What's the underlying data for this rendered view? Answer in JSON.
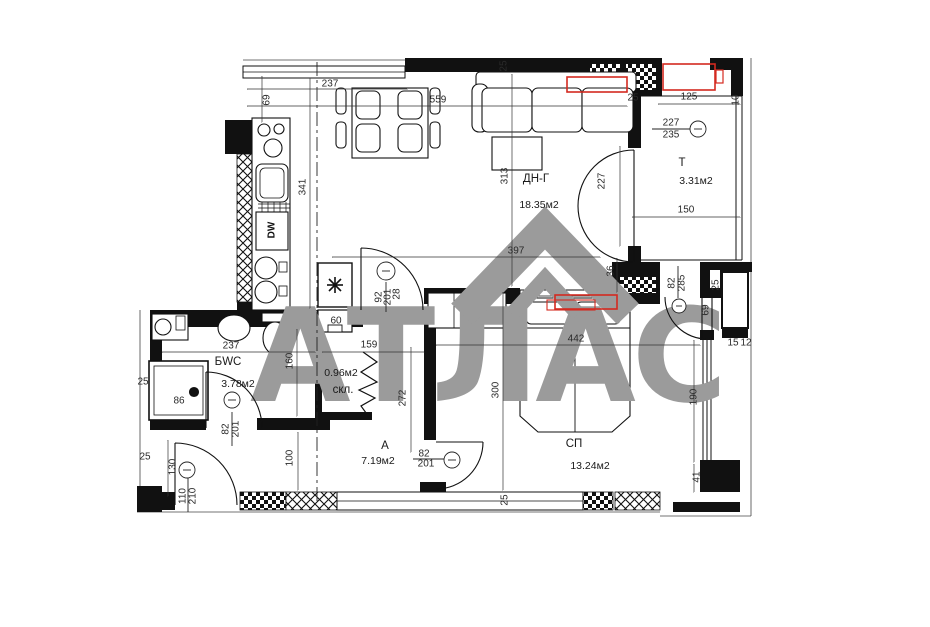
{
  "watermark": {
    "text": "АТЛАС"
  },
  "colors": {
    "ink": "#0f0f0f",
    "red": "#d42a20",
    "watermark_gray": "#9b9b9b"
  },
  "rooms": [
    {
      "name": "ДН-Г",
      "area": "18.35м2",
      "nx": 536,
      "ny": 179,
      "ax": 539,
      "ay": 205
    },
    {
      "name": "Т",
      "area": "3.31м2",
      "nx": 682,
      "ny": 163,
      "ax": 696,
      "ay": 181
    },
    {
      "name": "БWC",
      "area": "3.78м2",
      "nx": 228,
      "ny": 362,
      "ax": 238,
      "ay": 384
    },
    {
      "name": "скл.",
      "area": "0.96м2",
      "nx": 343,
      "ny": 390,
      "ax": 341,
      "ay": 373
    },
    {
      "name": "А",
      "area": "7.19м2",
      "nx": 385,
      "ny": 446,
      "ax": 378,
      "ay": 461
    },
    {
      "name": "СП",
      "area": "13.24м2",
      "nx": 574,
      "ny": 444,
      "ax": 590,
      "ay": 466
    }
  ],
  "labels": [
    {
      "t": "237",
      "x": 330,
      "y": 84
    },
    {
      "t": "69",
      "x": 267,
      "y": 100,
      "r": -90
    },
    {
      "t": "559",
      "x": 438,
      "y": 100
    },
    {
      "t": "25",
      "x": 504,
      "y": 66,
      "r": -90
    },
    {
      "t": "25",
      "x": 633,
      "y": 98
    },
    {
      "t": "125",
      "x": 689,
      "y": 97
    },
    {
      "t": "10",
      "x": 736,
      "y": 100,
      "r": -90
    },
    {
      "t": "227",
      "x": 671,
      "y": 123
    },
    {
      "t": "235",
      "x": 671,
      "y": 135
    },
    {
      "t": "150",
      "x": 686,
      "y": 210
    },
    {
      "t": "227",
      "x": 602,
      "y": 181,
      "r": -90
    },
    {
      "t": "313",
      "x": 505,
      "y": 176,
      "r": -90
    },
    {
      "t": "341",
      "x": 303,
      "y": 187,
      "r": -90
    },
    {
      "t": "397",
      "x": 516,
      "y": 251
    },
    {
      "t": "36",
      "x": 611,
      "y": 271,
      "r": -90
    },
    {
      "t": "92",
      "x": 379,
      "y": 297,
      "r": -90
    },
    {
      "t": "201",
      "x": 388,
      "y": 297,
      "r": -90
    },
    {
      "t": "28",
      "x": 397,
      "y": 294,
      "r": -90
    },
    {
      "t": "82",
      "x": 672,
      "y": 283,
      "r": -90
    },
    {
      "t": "285",
      "x": 682,
      "y": 283,
      "r": -90
    },
    {
      "t": "25",
      "x": 716,
      "y": 285,
      "r": -90
    },
    {
      "t": "69",
      "x": 706,
      "y": 310,
      "r": -90
    },
    {
      "t": "60",
      "x": 336,
      "y": 321
    },
    {
      "t": "159",
      "x": 369,
      "y": 345
    },
    {
      "t": "160",
      "x": 290,
      "y": 361,
      "r": -90
    },
    {
      "t": "237",
      "x": 231,
      "y": 346
    },
    {
      "t": "86",
      "x": 179,
      "y": 401
    },
    {
      "t": "25",
      "x": 143,
      "y": 382
    },
    {
      "t": "82",
      "x": 226,
      "y": 429,
      "r": -90
    },
    {
      "t": "201",
      "x": 236,
      "y": 429,
      "r": -90
    },
    {
      "t": "110",
      "x": 183,
      "y": 496,
      "r": -90
    },
    {
      "t": "210",
      "x": 193,
      "y": 496,
      "r": -90
    },
    {
      "t": "130",
      "x": 173,
      "y": 467,
      "r": -90
    },
    {
      "t": "25",
      "x": 145,
      "y": 457
    },
    {
      "t": "100",
      "x": 290,
      "y": 458,
      "r": -90
    },
    {
      "t": "272",
      "x": 403,
      "y": 398,
      "r": -90
    },
    {
      "t": "82",
      "x": 424,
      "y": 454
    },
    {
      "t": "201",
      "x": 426,
      "y": 464
    },
    {
      "t": "442",
      "x": 576,
      "y": 339
    },
    {
      "t": "300",
      "x": 496,
      "y": 390,
      "r": -90
    },
    {
      "t": "190",
      "x": 694,
      "y": 397,
      "r": -90
    },
    {
      "t": "41",
      "x": 697,
      "y": 477,
      "r": -90
    },
    {
      "t": "25",
      "x": 505,
      "y": 500,
      "r": -90
    },
    {
      "t": "15",
      "x": 733,
      "y": 343
    },
    {
      "t": "12",
      "x": 746,
      "y": 343
    },
    {
      "t": "DW",
      "x": 272,
      "y": 230,
      "r": -90,
      "cls": "fixture"
    }
  ]
}
